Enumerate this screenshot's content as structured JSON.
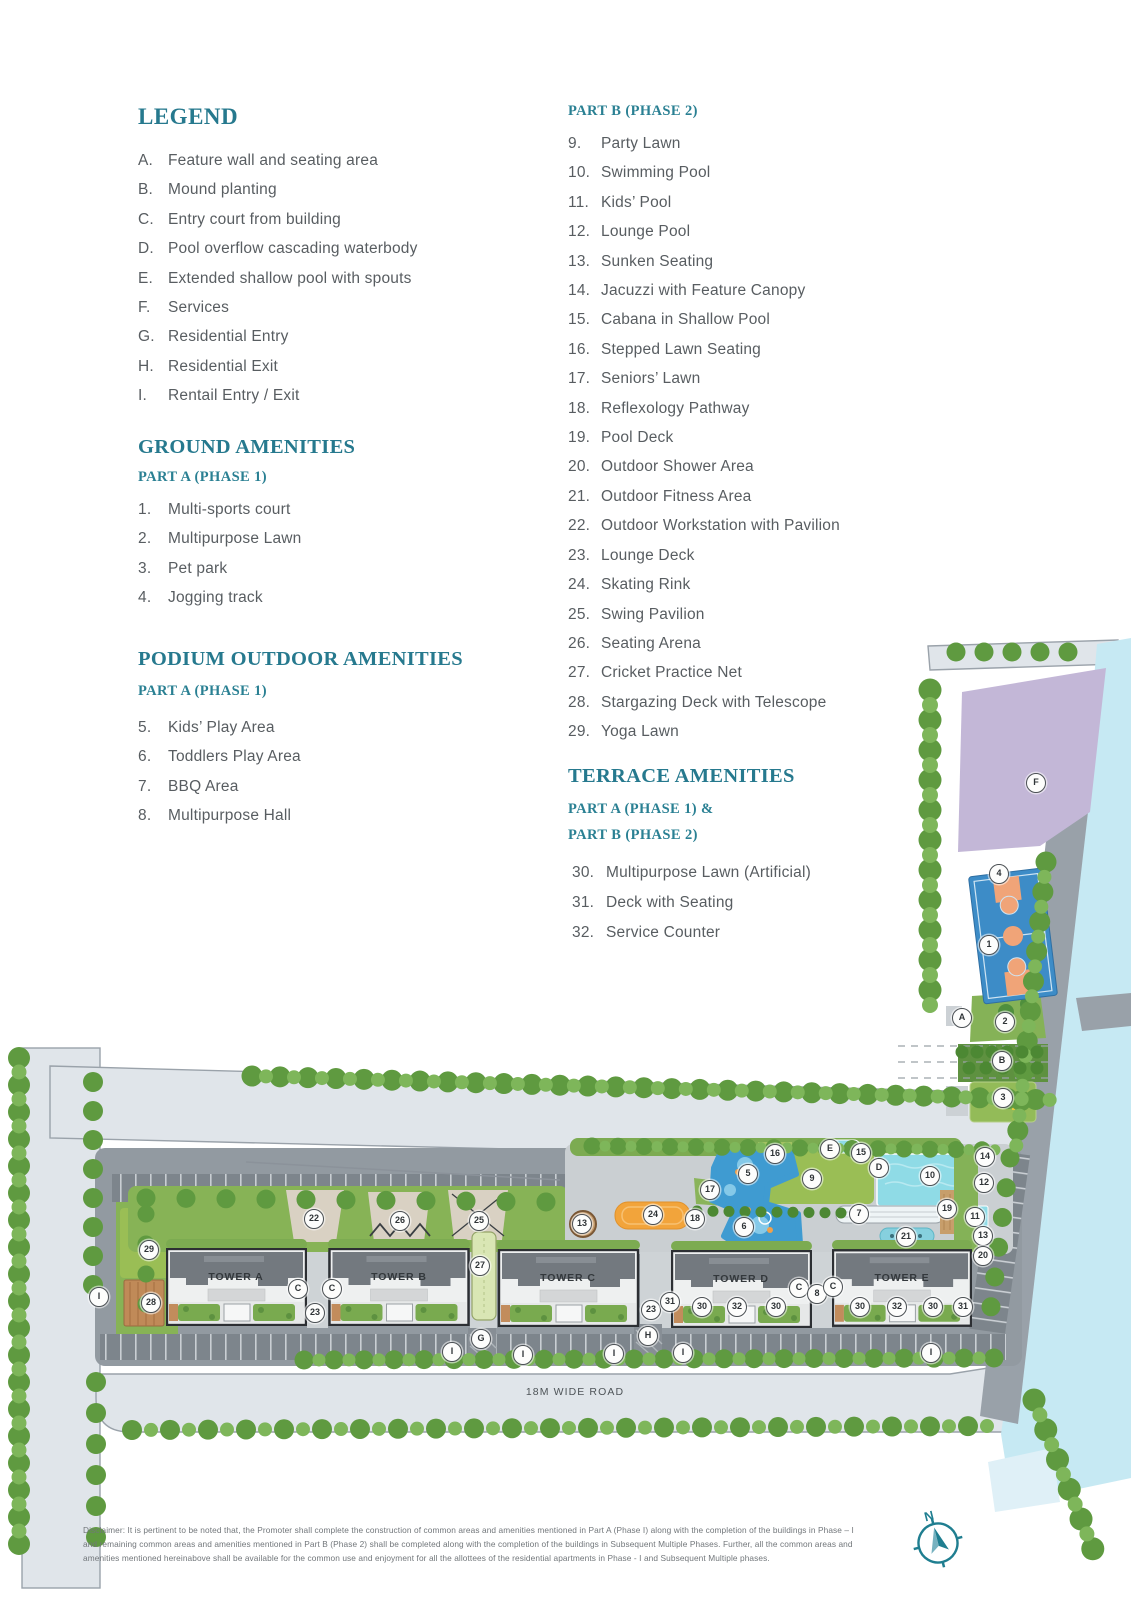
{
  "accent_color": "#26798e",
  "legend": {
    "title": "LEGEND",
    "items": [
      {
        "key": "A.",
        "label": "Feature wall and seating area"
      },
      {
        "key": "B.",
        "label": "Mound planting"
      },
      {
        "key": "C.",
        "label": "Entry court from building"
      },
      {
        "key": "D.",
        "label": "Pool overflow cascading waterbody"
      },
      {
        "key": "E.",
        "label": "Extended shallow pool with spouts"
      },
      {
        "key": "F.",
        "label": "Services"
      },
      {
        "key": "G.",
        "label": "Residential Entry"
      },
      {
        "key": "H.",
        "label": "Residential Exit"
      },
      {
        "key": "I.",
        "label": "Rentail Entry / Exit"
      }
    ]
  },
  "ground_amenities": {
    "title": "GROUND AMENITIES",
    "subtitle": "PART A (PHASE 1)",
    "items": [
      {
        "key": "1.",
        "label": "Multi-sports court"
      },
      {
        "key": "2.",
        "label": "Multipurpose Lawn"
      },
      {
        "key": "3.",
        "label": "Pet park"
      },
      {
        "key": "4.",
        "label": "Jogging track"
      }
    ]
  },
  "podium_amenities": {
    "title": "PODIUM OUTDOOR AMENITIES",
    "subtitle": "PART A (PHASE 1)",
    "items": [
      {
        "key": "5.",
        "label": "Kids’ Play Area"
      },
      {
        "key": "6.",
        "label": "Toddlers Play Area"
      },
      {
        "key": "7.",
        "label": "BBQ Area"
      },
      {
        "key": "8.",
        "label": "Multipurpose Hall"
      }
    ]
  },
  "part_b": {
    "title": "PART B (PHASE 2)",
    "items": [
      {
        "key": "9.",
        "label": "Party Lawn"
      },
      {
        "key": "10.",
        "label": "Swimming Pool"
      },
      {
        "key": "11.",
        "label": "Kids’ Pool"
      },
      {
        "key": "12.",
        "label": "Lounge Pool"
      },
      {
        "key": "13.",
        "label": "Sunken Seating"
      },
      {
        "key": "14.",
        "label": "Jacuzzi with Feature Canopy"
      },
      {
        "key": "15.",
        "label": "Cabana in Shallow Pool"
      },
      {
        "key": "16.",
        "label": "Stepped Lawn Seating"
      },
      {
        "key": "17.",
        "label": "Seniors’ Lawn"
      },
      {
        "key": "18.",
        "label": "Reflexology Pathway"
      },
      {
        "key": "19.",
        "label": "Pool Deck"
      },
      {
        "key": "20.",
        "label": "Outdoor Shower Area"
      },
      {
        "key": "21.",
        "label": "Outdoor Fitness Area"
      },
      {
        "key": "22.",
        "label": "Outdoor Workstation with Pavilion"
      },
      {
        "key": "23.",
        "label": "Lounge Deck"
      },
      {
        "key": "24.",
        "label": "Skating Rink"
      },
      {
        "key": "25.",
        "label": "Swing Pavilion"
      },
      {
        "key": "26.",
        "label": "Seating Arena"
      },
      {
        "key": "27.",
        "label": "Cricket Practice Net"
      },
      {
        "key": "28.",
        "label": "Stargazing Deck with Telescope"
      },
      {
        "key": "29.",
        "label": "Yoga Lawn"
      }
    ]
  },
  "terrace_amenities": {
    "title": "TERRACE AMENITIES",
    "subtitles": [
      "PART A (PHASE 1) &",
      "PART B (PHASE 2)"
    ],
    "items": [
      {
        "key": "30.",
        "label": "Multipurpose Lawn (Artificial)"
      },
      {
        "key": "31.",
        "label": "Deck with Seating"
      },
      {
        "key": "32.",
        "label": "Service Counter"
      }
    ]
  },
  "site_plan": {
    "road_label": "18M WIDE ROAD",
    "compass_north_label": "N",
    "tower_labels": [
      {
        "name": "TOWER A",
        "x": 236,
        "y": 1277
      },
      {
        "name": "TOWER B",
        "x": 399,
        "y": 1277
      },
      {
        "name": "TOWER C",
        "x": 568,
        "y": 1278
      },
      {
        "name": "TOWER D",
        "x": 741,
        "y": 1279
      },
      {
        "name": "TOWER E",
        "x": 902,
        "y": 1278
      }
    ],
    "markers": [
      {
        "label": "F",
        "x": 1036,
        "y": 783
      },
      {
        "label": "4",
        "x": 999,
        "y": 874
      },
      {
        "label": "1",
        "x": 989,
        "y": 945
      },
      {
        "label": "A",
        "x": 962,
        "y": 1018
      },
      {
        "label": "2",
        "x": 1005,
        "y": 1022
      },
      {
        "label": "B",
        "x": 1002,
        "y": 1061
      },
      {
        "label": "3",
        "x": 1003,
        "y": 1098
      },
      {
        "label": "29",
        "x": 149,
        "y": 1250
      },
      {
        "label": "28",
        "x": 151,
        "y": 1303
      },
      {
        "label": "I",
        "x": 99,
        "y": 1297
      },
      {
        "label": "22",
        "x": 314,
        "y": 1219
      },
      {
        "label": "26",
        "x": 400,
        "y": 1221
      },
      {
        "label": "25",
        "x": 479,
        "y": 1221
      },
      {
        "label": "27",
        "x": 480,
        "y": 1266
      },
      {
        "label": "C",
        "x": 298,
        "y": 1289
      },
      {
        "label": "C",
        "x": 332,
        "y": 1289
      },
      {
        "label": "23",
        "x": 315,
        "y": 1313
      },
      {
        "label": "G",
        "x": 481,
        "y": 1339
      },
      {
        "label": "I",
        "x": 452,
        "y": 1352
      },
      {
        "label": "I",
        "x": 523,
        "y": 1355
      },
      {
        "label": "13",
        "x": 582,
        "y": 1224
      },
      {
        "label": "24",
        "x": 653,
        "y": 1215
      },
      {
        "label": "18",
        "x": 695,
        "y": 1219
      },
      {
        "label": "17",
        "x": 710,
        "y": 1190
      },
      {
        "label": "5",
        "x": 748,
        "y": 1174
      },
      {
        "label": "6",
        "x": 744,
        "y": 1227
      },
      {
        "label": "16",
        "x": 775,
        "y": 1154
      },
      {
        "label": "9",
        "x": 812,
        "y": 1179
      },
      {
        "label": "E",
        "x": 830,
        "y": 1149
      },
      {
        "label": "15",
        "x": 861,
        "y": 1153
      },
      {
        "label": "D",
        "x": 879,
        "y": 1168
      },
      {
        "label": "10",
        "x": 930,
        "y": 1176
      },
      {
        "label": "14",
        "x": 985,
        "y": 1157
      },
      {
        "label": "12",
        "x": 984,
        "y": 1183
      },
      {
        "label": "7",
        "x": 859,
        "y": 1214
      },
      {
        "label": "19",
        "x": 947,
        "y": 1209
      },
      {
        "label": "11",
        "x": 975,
        "y": 1217
      },
      {
        "label": "21",
        "x": 906,
        "y": 1237
      },
      {
        "label": "13",
        "x": 983,
        "y": 1236
      },
      {
        "label": "20",
        "x": 983,
        "y": 1256
      },
      {
        "label": "23",
        "x": 651,
        "y": 1310
      },
      {
        "label": "31",
        "x": 670,
        "y": 1302
      },
      {
        "label": "30",
        "x": 702,
        "y": 1307
      },
      {
        "label": "32",
        "x": 737,
        "y": 1307
      },
      {
        "label": "30",
        "x": 776,
        "y": 1307
      },
      {
        "label": "C",
        "x": 799,
        "y": 1288
      },
      {
        "label": "8",
        "x": 817,
        "y": 1294
      },
      {
        "label": "C",
        "x": 833,
        "y": 1287
      },
      {
        "label": "30",
        "x": 860,
        "y": 1307
      },
      {
        "label": "32",
        "x": 897,
        "y": 1307
      },
      {
        "label": "30",
        "x": 933,
        "y": 1307
      },
      {
        "label": "31",
        "x": 963,
        "y": 1307
      },
      {
        "label": "H",
        "x": 648,
        "y": 1336
      },
      {
        "label": "I",
        "x": 614,
        "y": 1354
      },
      {
        "label": "I",
        "x": 683,
        "y": 1353
      },
      {
        "label": "I",
        "x": 931,
        "y": 1353
      }
    ]
  },
  "disclaimer": "Disclaimer: It is pertinent to be noted that, the Promoter shall complete the construction of common areas and amenities mentioned in Part A (Phase I) along with the completion of the buildings in Phase – I and remaining common areas and amenities mentioned in Part B (Phase 2) shall be completed along with the completion of the buildings in Subsequent Multiple Phases. Further, all the common areas and amenities mentioned hereinabove shall be available for the common use and enjoyment for all the allottees of the residential apartments in Phase - I and Subsequent Multiple phases."
}
